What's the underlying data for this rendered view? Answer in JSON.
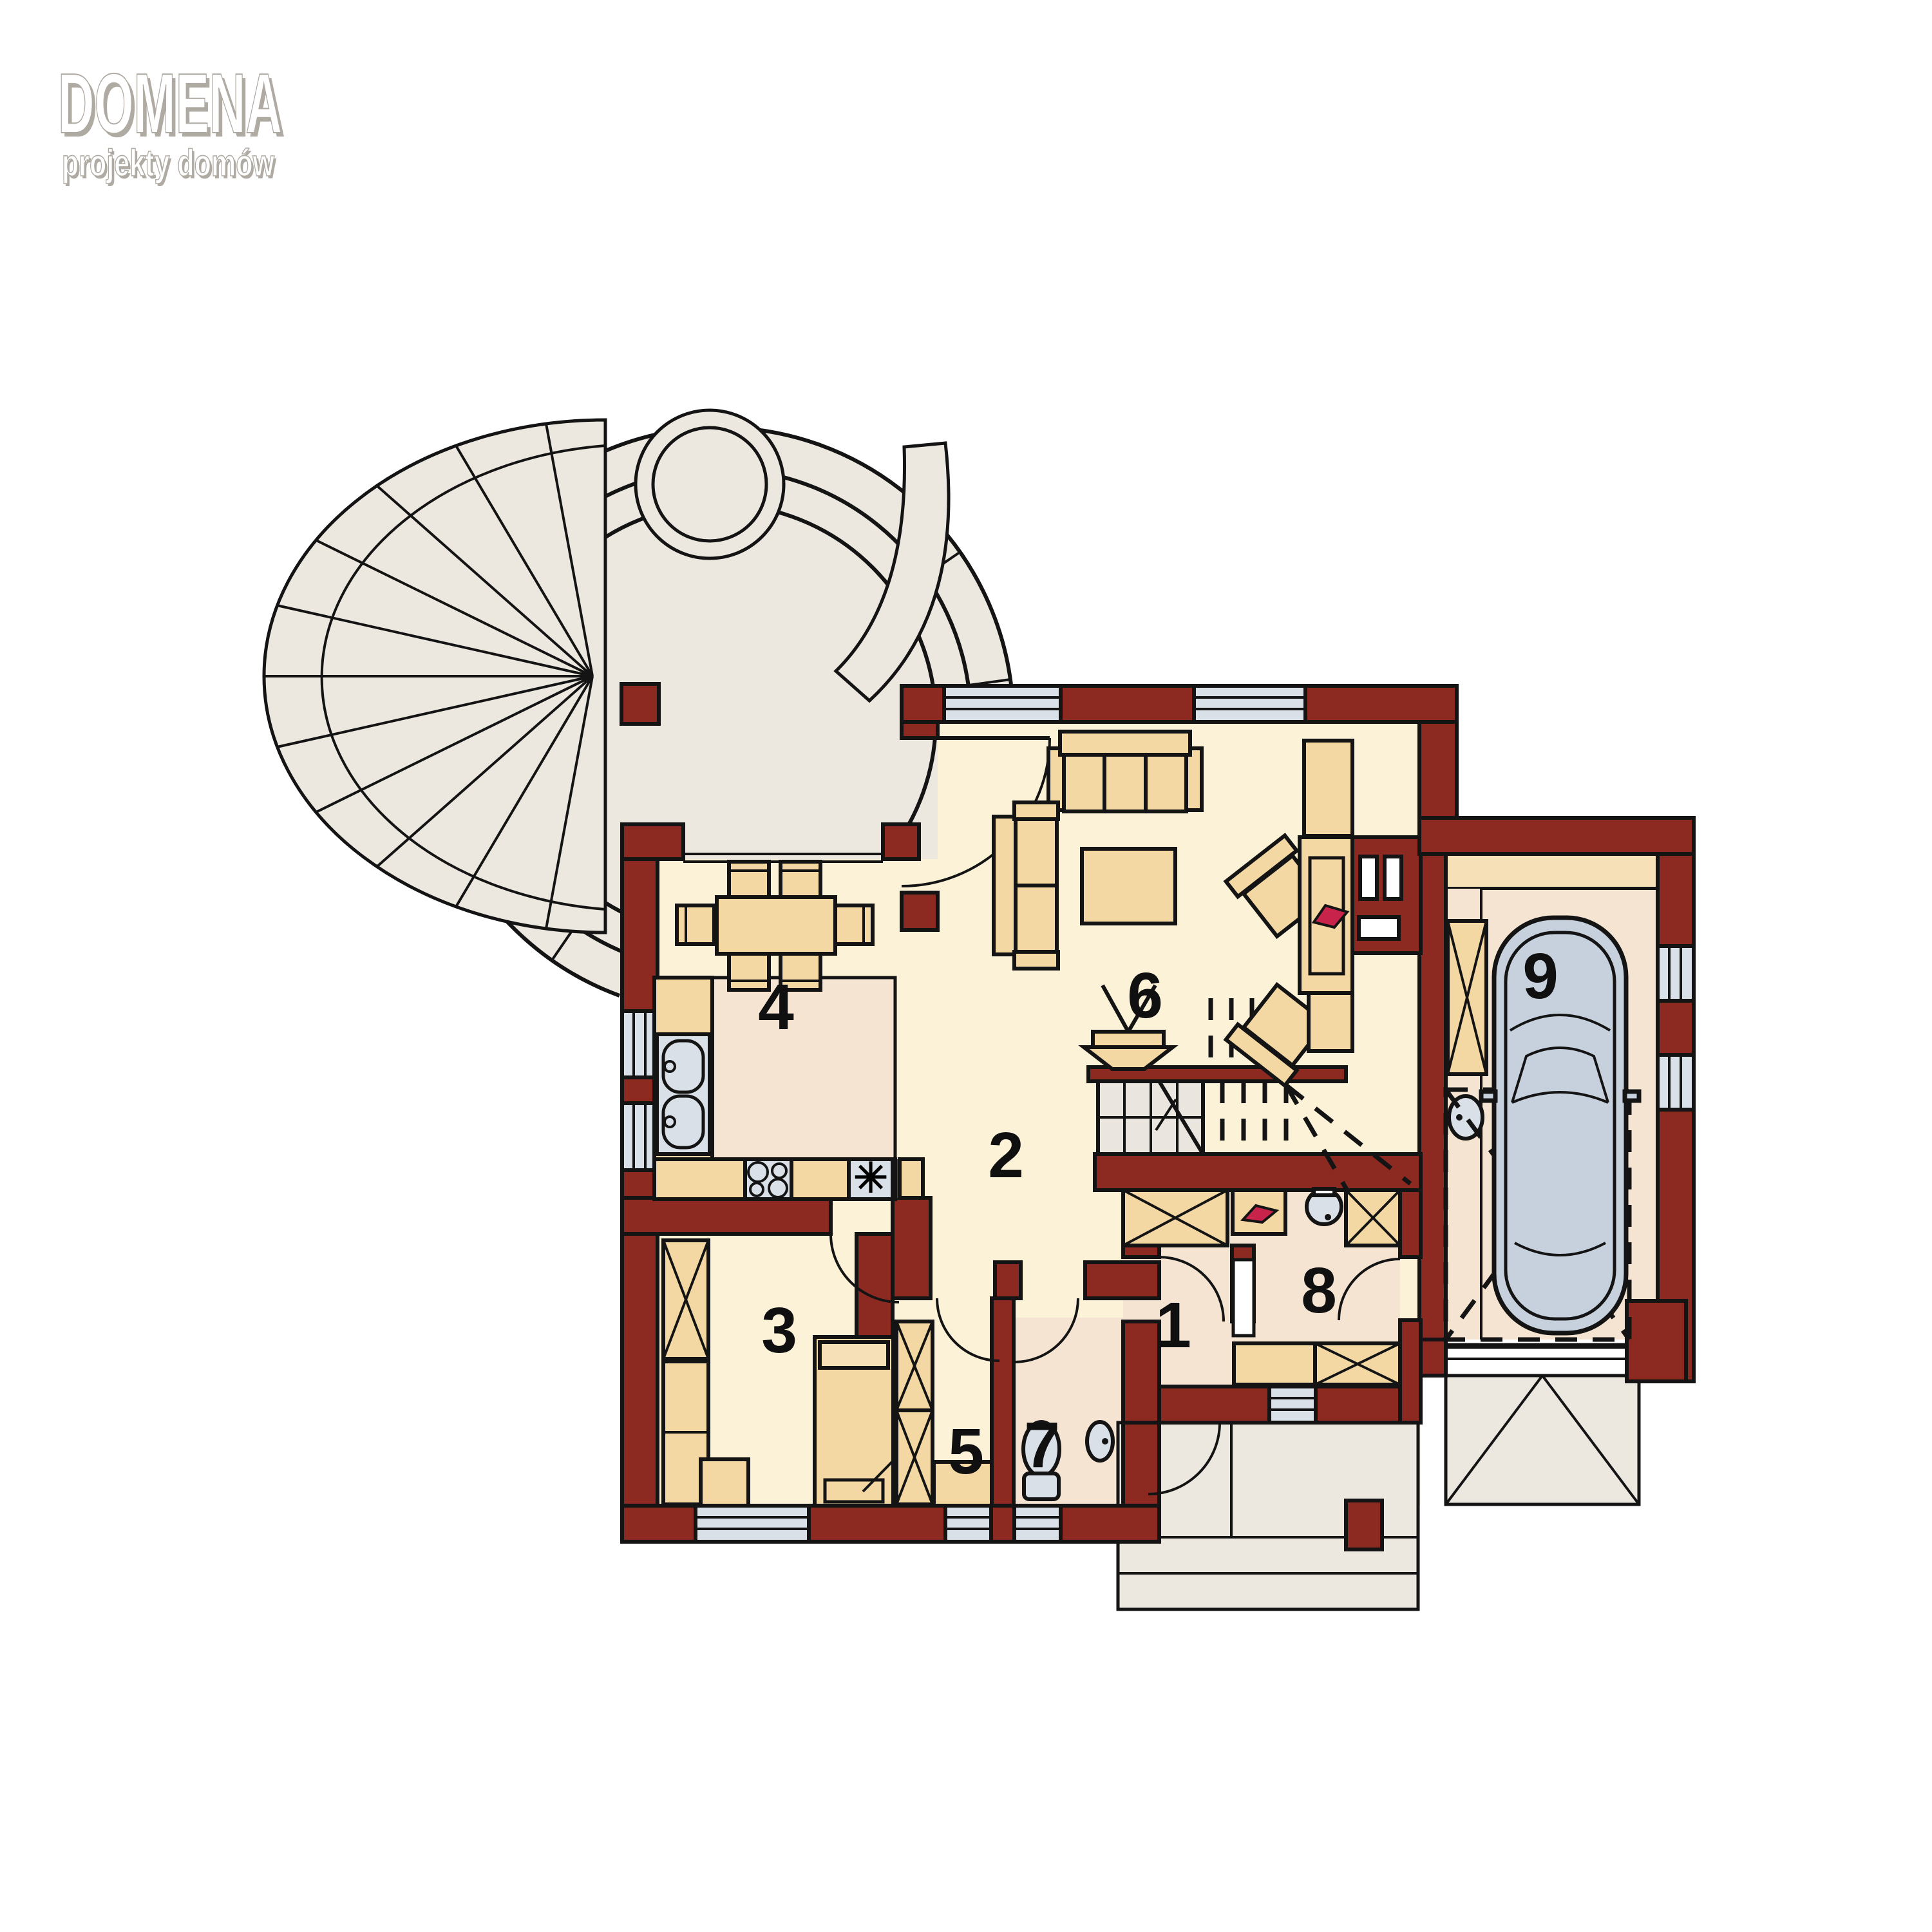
{
  "logo": {
    "title": "DOMENA",
    "subtitle": "projekty domów"
  },
  "rooms": [
    {
      "number": "1"
    },
    {
      "number": "2"
    },
    {
      "number": "3"
    },
    {
      "number": "4"
    },
    {
      "number": "5"
    },
    {
      "number": "6"
    },
    {
      "number": "7"
    },
    {
      "number": "8"
    },
    {
      "number": "9"
    }
  ],
  "icons": {
    "appliance_symbol": "✳"
  },
  "colors": {
    "background": "#FFFFFF",
    "wall": "#8C2A21",
    "floor": "#FBF2D7",
    "floor_accent": "#F6E4D2",
    "terrace": "#ECE8E0",
    "furniture": "#F3D8A3",
    "furniture_light": "#F6E0B8",
    "glass": "#D9E0E7",
    "steps": "#EAE5DE",
    "car": "#C7D1DE",
    "flame": "#C8234A",
    "outline": "#141414",
    "logo": "#FFFFFF",
    "logo_shadow": "#AFAAA2"
  }
}
